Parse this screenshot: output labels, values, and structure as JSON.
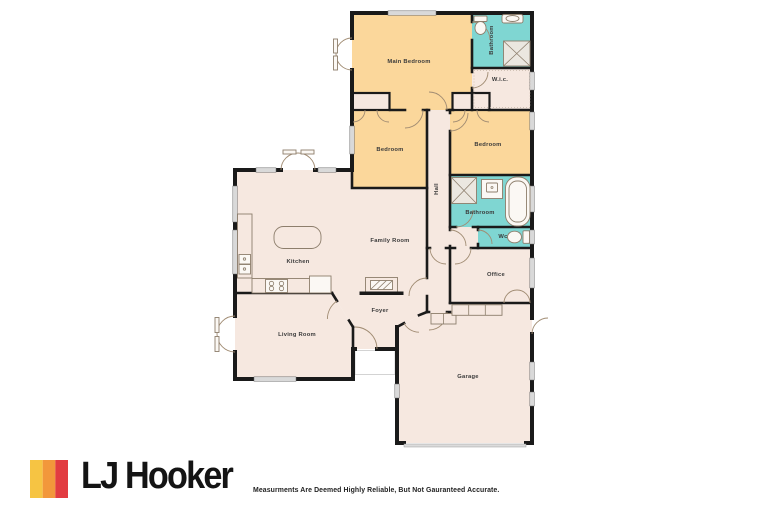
{
  "floorplan": {
    "rooms": {
      "main_bedroom": "Main Bedroom",
      "bathroom_top": "Bathroom",
      "wic": "W.i.c.",
      "bedroom_left": "Bedroom",
      "bedroom_right": "Bedroom",
      "hall": "Hall",
      "bathroom_mid": "Bathroom",
      "wc": "Wc",
      "family_room": "Family Room",
      "kitchen": "Kitchen",
      "living_room": "Living Room",
      "foyer": "Foyer",
      "office": "Office",
      "garage": "Garage"
    },
    "colors": {
      "bedroom_fill": "#FBD79B",
      "bathroom_fill": "#7FD6D2",
      "room_fill": "#F6E8E0",
      "wall": "#1A1A1A",
      "window": "#D9D9D9",
      "fixture_line": "#8D7E6C",
      "label_text": "#3A3A3A"
    }
  },
  "footer": {
    "brand": "LJ Hooker",
    "logo_colors": {
      "yellow": "#F6C443",
      "orange": "#F2973B",
      "red": "#E23C41"
    },
    "disclaimer": "Measurments Are Deemed Highly Reliable, But Not Gauranteed Accurate."
  }
}
